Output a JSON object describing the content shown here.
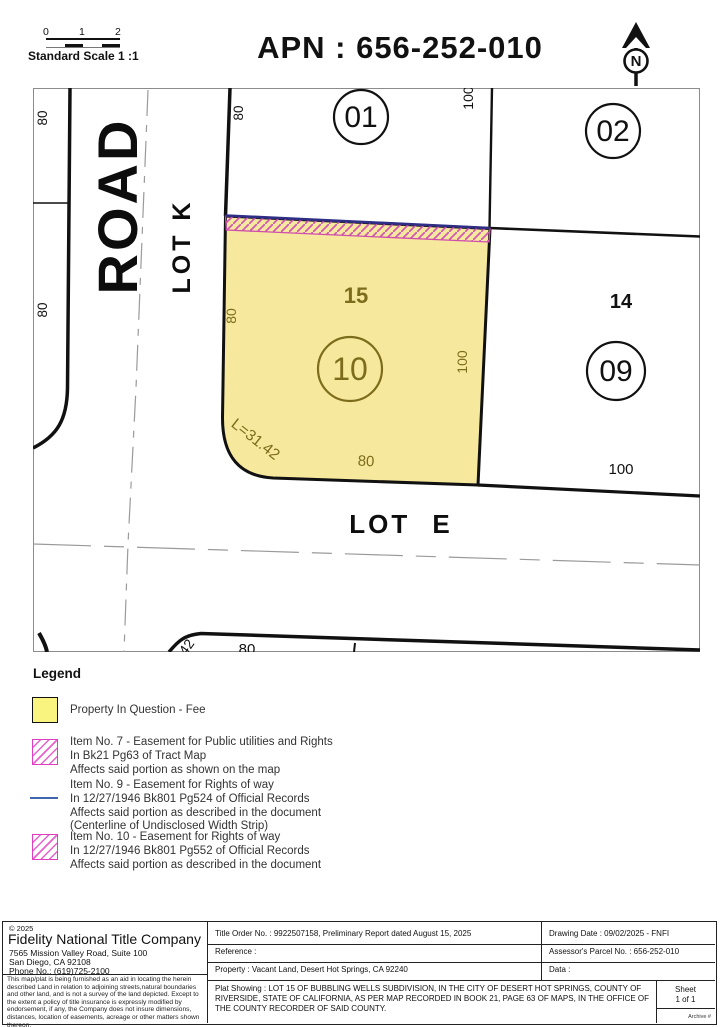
{
  "header": {
    "title": "APN : 656-252-010",
    "scale_label": "Standard Scale 1 :1",
    "scale_ticks": [
      "0",
      "1",
      "2"
    ],
    "north_letter": "N"
  },
  "map": {
    "road": "ROAD",
    "lot_k": "LOT K",
    "lot_e": "LOT E",
    "parcels": {
      "p01": "01",
      "p02": "02",
      "p09": "09",
      "p10": "10",
      "lot15": "15",
      "lot14": "14"
    },
    "dims": {
      "d80_left_top": "80",
      "d80_left_mid": "80",
      "d80_road_top": "80",
      "d100_top_right": "100",
      "d80_parcel_west": "80",
      "d100_parcel_east": "100",
      "d80_parcel_south": "80",
      "d100_south_right": "100",
      "curve_len": "L=31.42",
      "bottom_80": "80",
      "bottom_42": "42"
    },
    "colors": {
      "fee_fill": "#f6e89c",
      "olive": "#7c6d1d",
      "magenta": "#d155b2",
      "strip_top_blue": "#2f2e85",
      "centerline_gray": "#9a9a9a"
    }
  },
  "legend": {
    "title": "Legend",
    "items": [
      {
        "swatch": "fee",
        "lines": [
          "Property In Question - Fee"
        ]
      },
      {
        "swatch": "hatch",
        "lines": [
          "Item No. 7 - Easement for Public utilities and Rights",
          "In Bk21 Pg63 of Tract Map",
          "Affects said portion as shown on the map"
        ]
      },
      {
        "swatch": "blue-line",
        "lines": [
          "Item No. 9 - Easement for Rights of way",
          "In 12/27/1946 Bk801 Pg524 of Official Records",
          "Affects said portion as described in the document",
          "(Centerline of Undisclosed Width Strip)"
        ]
      },
      {
        "swatch": "hatch",
        "lines": [
          "Item No. 10 - Easement for Rights of way",
          "In 12/27/1946 Bk801 Pg552 of Official Records",
          "Affects said portion as described in the document"
        ]
      }
    ],
    "blue_line_color": "#4166ac"
  },
  "titleblock": {
    "copyright": "© 2025",
    "company": "Fidelity National Title Company",
    "address1": "7565 Mission Valley Road, Suite 100",
    "address2": "San Diego, CA 92108",
    "phone": "Phone No.: (619)725-2100",
    "disclaimer": "This map/plat is being furnished as an aid in locating the herein described Land in relation to adjoining streets,natural boundaries and other land, and is not a survey of the land depicted. Except to the extent a policy of title insurance is expressly modified by endorsement, if any, the Company does not insure dimensions, distances, location of easements, acreage or other matters shown thereon.",
    "title_order": "Title Order No. : 9922507158, Preliminary Report dated August 15, 2025",
    "reference": "Reference :",
    "property": "Property : Vacant Land, Desert Hot Springs, CA 92240",
    "drawing_date": "Drawing Date : 09/02/2025 - FNFI",
    "apn": "Assessor's Parcel No. : 656-252-010",
    "data_label": "Data :",
    "plat": "Plat Showing : LOT 15 OF BUBBLING WELLS SUBDIVISION, IN THE CITY OF DESERT HOT SPRINGS, COUNTY OF RIVERSIDE, STATE OF CALIFORNIA, AS PER MAP RECORDED IN BOOK 21, PAGE 63 OF MAPS, IN THE OFFICE OF THE COUNTY RECORDER OF SAID COUNTY.",
    "sheet_label": "Sheet",
    "sheet_value": "1 of 1",
    "archive": "Archive #"
  }
}
